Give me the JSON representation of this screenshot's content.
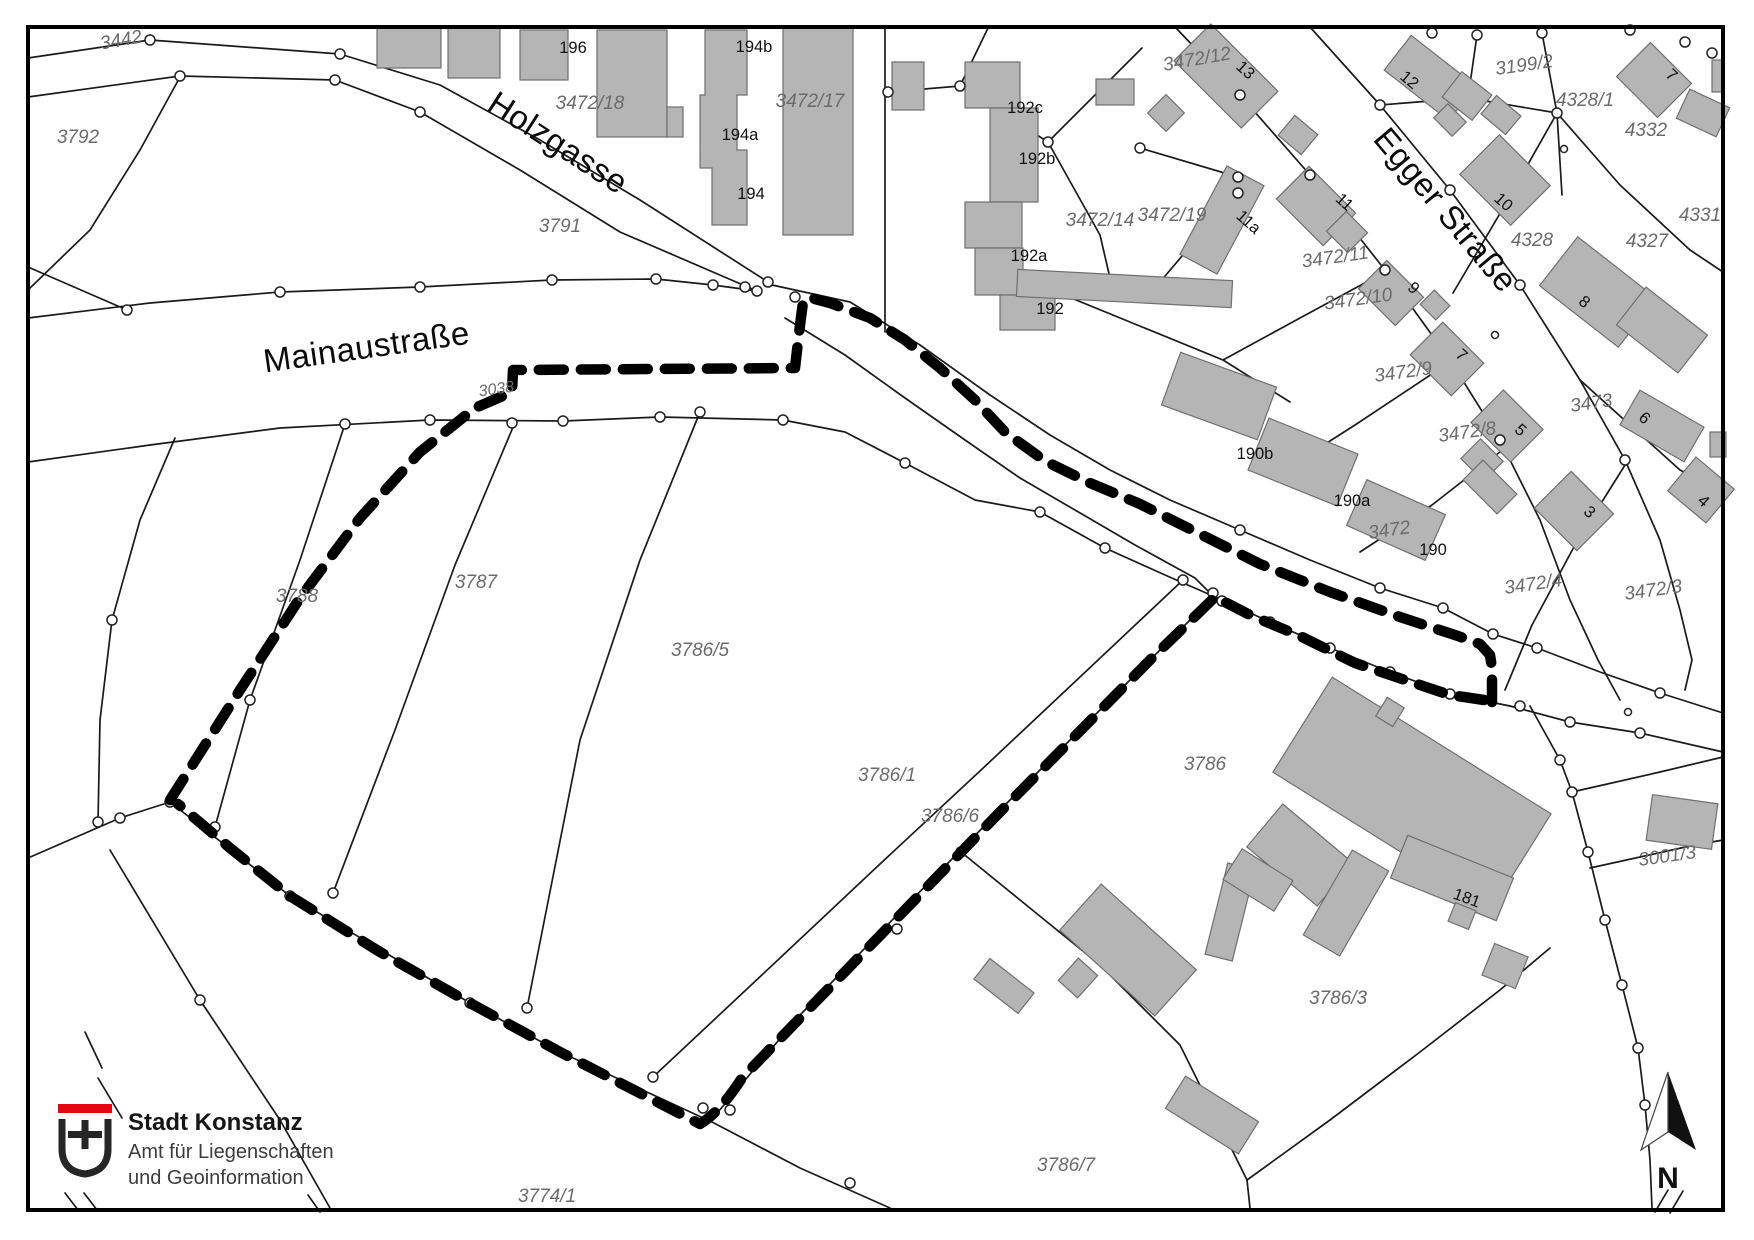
{
  "streets": {
    "holzgasse": "Holzgasse",
    "mainaustrasse": "Mainaustraße",
    "egger_strasse": "Egger Straße"
  },
  "parcels": {
    "p3442": "3442",
    "p3792": "3792",
    "p3791": "3791",
    "p3472_18": "3472/18",
    "p3472_17": "3472/17",
    "p3472_14": "3472/14",
    "p3472_19": "3472/19",
    "p3472_12": "3472/12",
    "p3199_2": "3199/2",
    "p4328_1": "4328/1",
    "p4332": "4332",
    "p4331": "4331",
    "p4328": "4328",
    "p4327": "4327",
    "p3472_11": "3472/11",
    "p3472_10": "3472/10",
    "p3472_9": "3472/9",
    "p3472_8": "3472/8",
    "p3473": "3473",
    "p3472": "3472",
    "p3472_4": "3472/4",
    "p3472_3": "3472/3",
    "p3038": "3038",
    "p3788": "3788",
    "p3787": "3787",
    "p3786_5": "3786/5",
    "p3786_1": "3786/1",
    "p3786_6": "3786/6",
    "p3786": "3786",
    "p3001_3": "3001/3",
    "p3786_3": "3786/3",
    "p3786_7": "3786/7",
    "p3774_1": "3774/1"
  },
  "houses": {
    "h196": "196",
    "h194b": "194b",
    "h194a": "194a",
    "h194": "194",
    "h192c": "192c",
    "h192b": "192b",
    "h192a": "192a",
    "h192": "192",
    "h13": "13",
    "h11a": "11a",
    "h11": "11",
    "h9": "9",
    "h12": "12",
    "h10": "10",
    "h7_top": "7",
    "h8": "8",
    "h7_mid": "7",
    "h5": "5",
    "h6": "6",
    "h4": "4",
    "h3": "3",
    "h190b": "190b",
    "h190a": "190a",
    "h190": "190",
    "h181": "181"
  },
  "logo": {
    "title": "Stadt Konstanz",
    "subtitle_line1": "Amt für Liegenschaften",
    "subtitle_line2": "und Geoinformation"
  },
  "north_arrow": {
    "label": "N"
  },
  "colors": {
    "line": "#1a1a1a",
    "boundary_dash": "#000000",
    "building_fill": "#b5b5b5",
    "building_stroke": "#6f6f6f",
    "parcel_text": "#6b6b6b",
    "house_text": "#111111",
    "logo_red": "#e30613"
  }
}
